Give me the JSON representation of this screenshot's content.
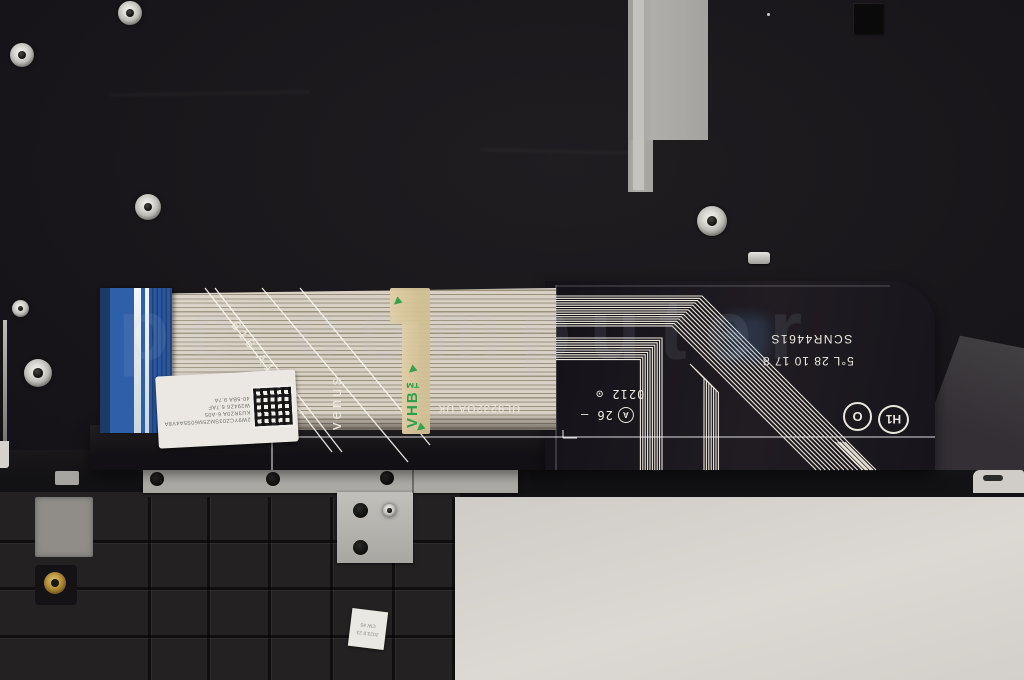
{
  "photo": {
    "subject": "Internal view of a dark laptop palmrest assembly with attached keyboard flex cable",
    "watermark": "pc computer"
  },
  "cable": {
    "serial": "SCNR4461S",
    "date_code": "5°L 28 10 17 8",
    "cert_code": "UL9232OA UK",
    "lot_code": "616 A1-2",
    "codename": "venus",
    "seg_line1": "0212 ⊙",
    "seg_line2": "26 —",
    "circle_a": "A",
    "circle_o": "O",
    "circle_h": "H1",
    "tape_brand": "VHB™",
    "qr_label_lines": [
      "2W9YCZ03SMZ5M60S5A4V8A",
      "KU3RZ0A 6-A05",
      "W294Z6 6.7AF",
      "40-5BA 9.7A"
    ]
  },
  "palmrest": {
    "bottom_label_lines": [
      "CW #5",
      "2023.8 23"
    ]
  },
  "colors": {
    "chassis": "#18161a",
    "ribbon": "#d3ccbf",
    "connector_blue": "#2e5fa9",
    "trace_white": "#ece7db",
    "tape_tan": "#d8c79c",
    "tape_green": "#2da04b",
    "touchpad_gray": "#d8d4cf",
    "bracket_gray": "#b6b3ae"
  }
}
